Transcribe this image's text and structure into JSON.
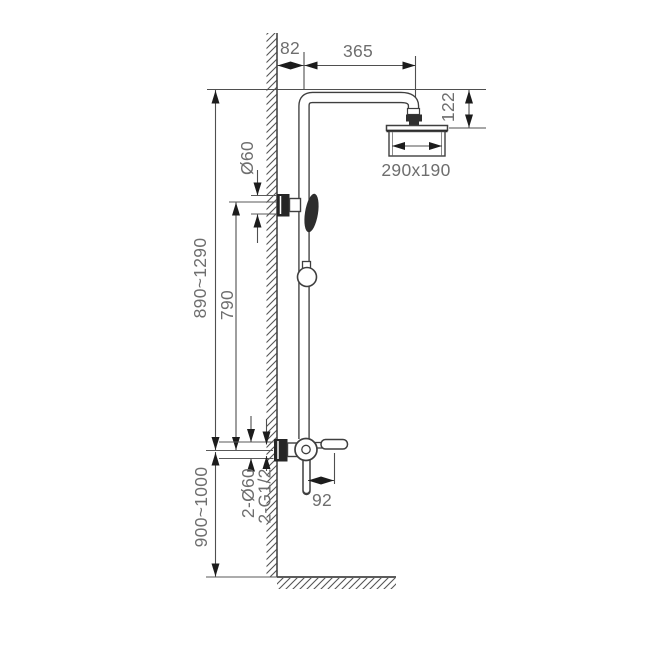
{
  "drawing": {
    "type": "technical-dimension-drawing",
    "subject": "wall-mounted shower column with overhead shower, hand shower and mixer",
    "colors": {
      "background": "#ffffff",
      "drawing_line": "#3f3f3f",
      "dimension_line": "#4f4f4f",
      "arrow": "#1c1c1c",
      "dark_fill": "#262626",
      "text": "#6e6e6e"
    },
    "labels": {
      "wall_offset": "82",
      "arm_reach": "365",
      "head_drop": "122",
      "head_size": "290x190",
      "holder_flange_diameter": "Ø60",
      "overall_height": "890~1290",
      "bar_height": "790",
      "mixer_floor_height": "900~1000",
      "spout_reach": "92",
      "inlet_flange_diameter": "2-Ø60",
      "inlet_thread": "2-G1/2"
    }
  }
}
